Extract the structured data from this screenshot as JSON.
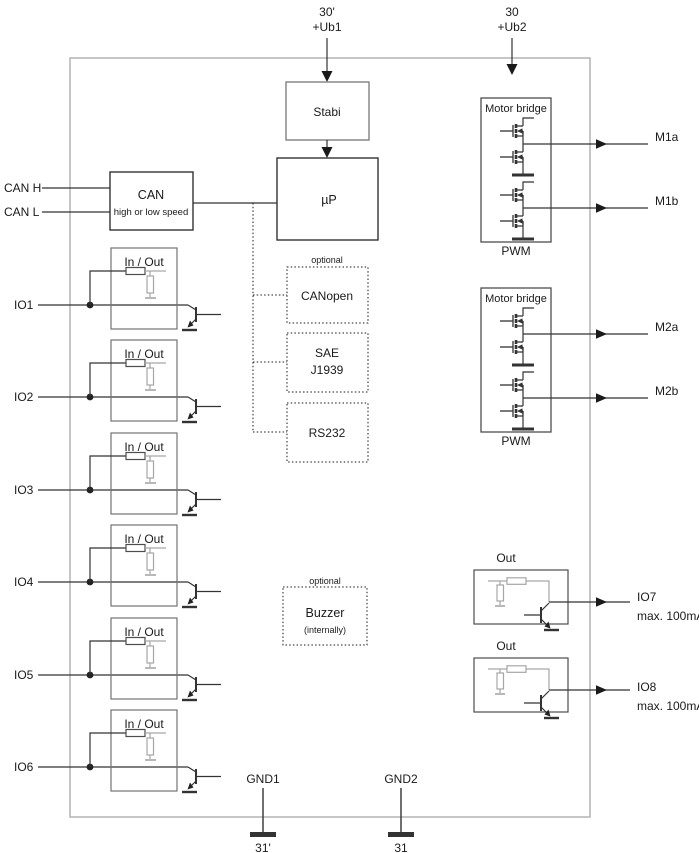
{
  "power": [
    {
      "pin": "30'",
      "net": "+Ub1"
    },
    {
      "pin": "30",
      "net": "+Ub2"
    }
  ],
  "can_pins": [
    {
      "label": "CAN H"
    },
    {
      "label": "CAN L"
    }
  ],
  "blocks": {
    "stabi": "Stabi",
    "mcu": "µP",
    "can_title": "CAN",
    "can_subtitle": "high or low speed",
    "io_title": "In / Out",
    "out_title": "Out",
    "motor_title": "Motor bridge",
    "pwm": "PWM",
    "optional": "optional",
    "buzzer_title": "Buzzer",
    "buzzer_subtitle": "(internally)"
  },
  "protocols": [
    {
      "line1": "CANopen",
      "line2": ""
    },
    {
      "line1": "SAE",
      "line2": "J1939"
    },
    {
      "line1": "RS232",
      "line2": ""
    }
  ],
  "io_channels": [
    {
      "label": "IO1"
    },
    {
      "label": "IO2"
    },
    {
      "label": "IO3"
    },
    {
      "label": "IO4"
    },
    {
      "label": "IO5"
    },
    {
      "label": "IO6"
    }
  ],
  "motor_outputs": [
    {
      "label": "M1a"
    },
    {
      "label": "M1b"
    },
    {
      "label": "M2a"
    },
    {
      "label": "M2b"
    }
  ],
  "power_outputs": [
    {
      "label": "IO7",
      "rating": "max. 100mA"
    },
    {
      "label": "IO8",
      "rating": "max. 100mA"
    }
  ],
  "grounds": [
    {
      "label": "GND1",
      "pin": "31'"
    },
    {
      "label": "GND2",
      "pin": "31"
    }
  ],
  "colors": {
    "wire": "#333333",
    "component_border": "#4d4d4d",
    "io_box_border": "#737373",
    "outer_border": "#b3b3b3",
    "gray_circuit": "#a6a6a6",
    "text": "#1a1a1a",
    "background": "#ffffff"
  }
}
